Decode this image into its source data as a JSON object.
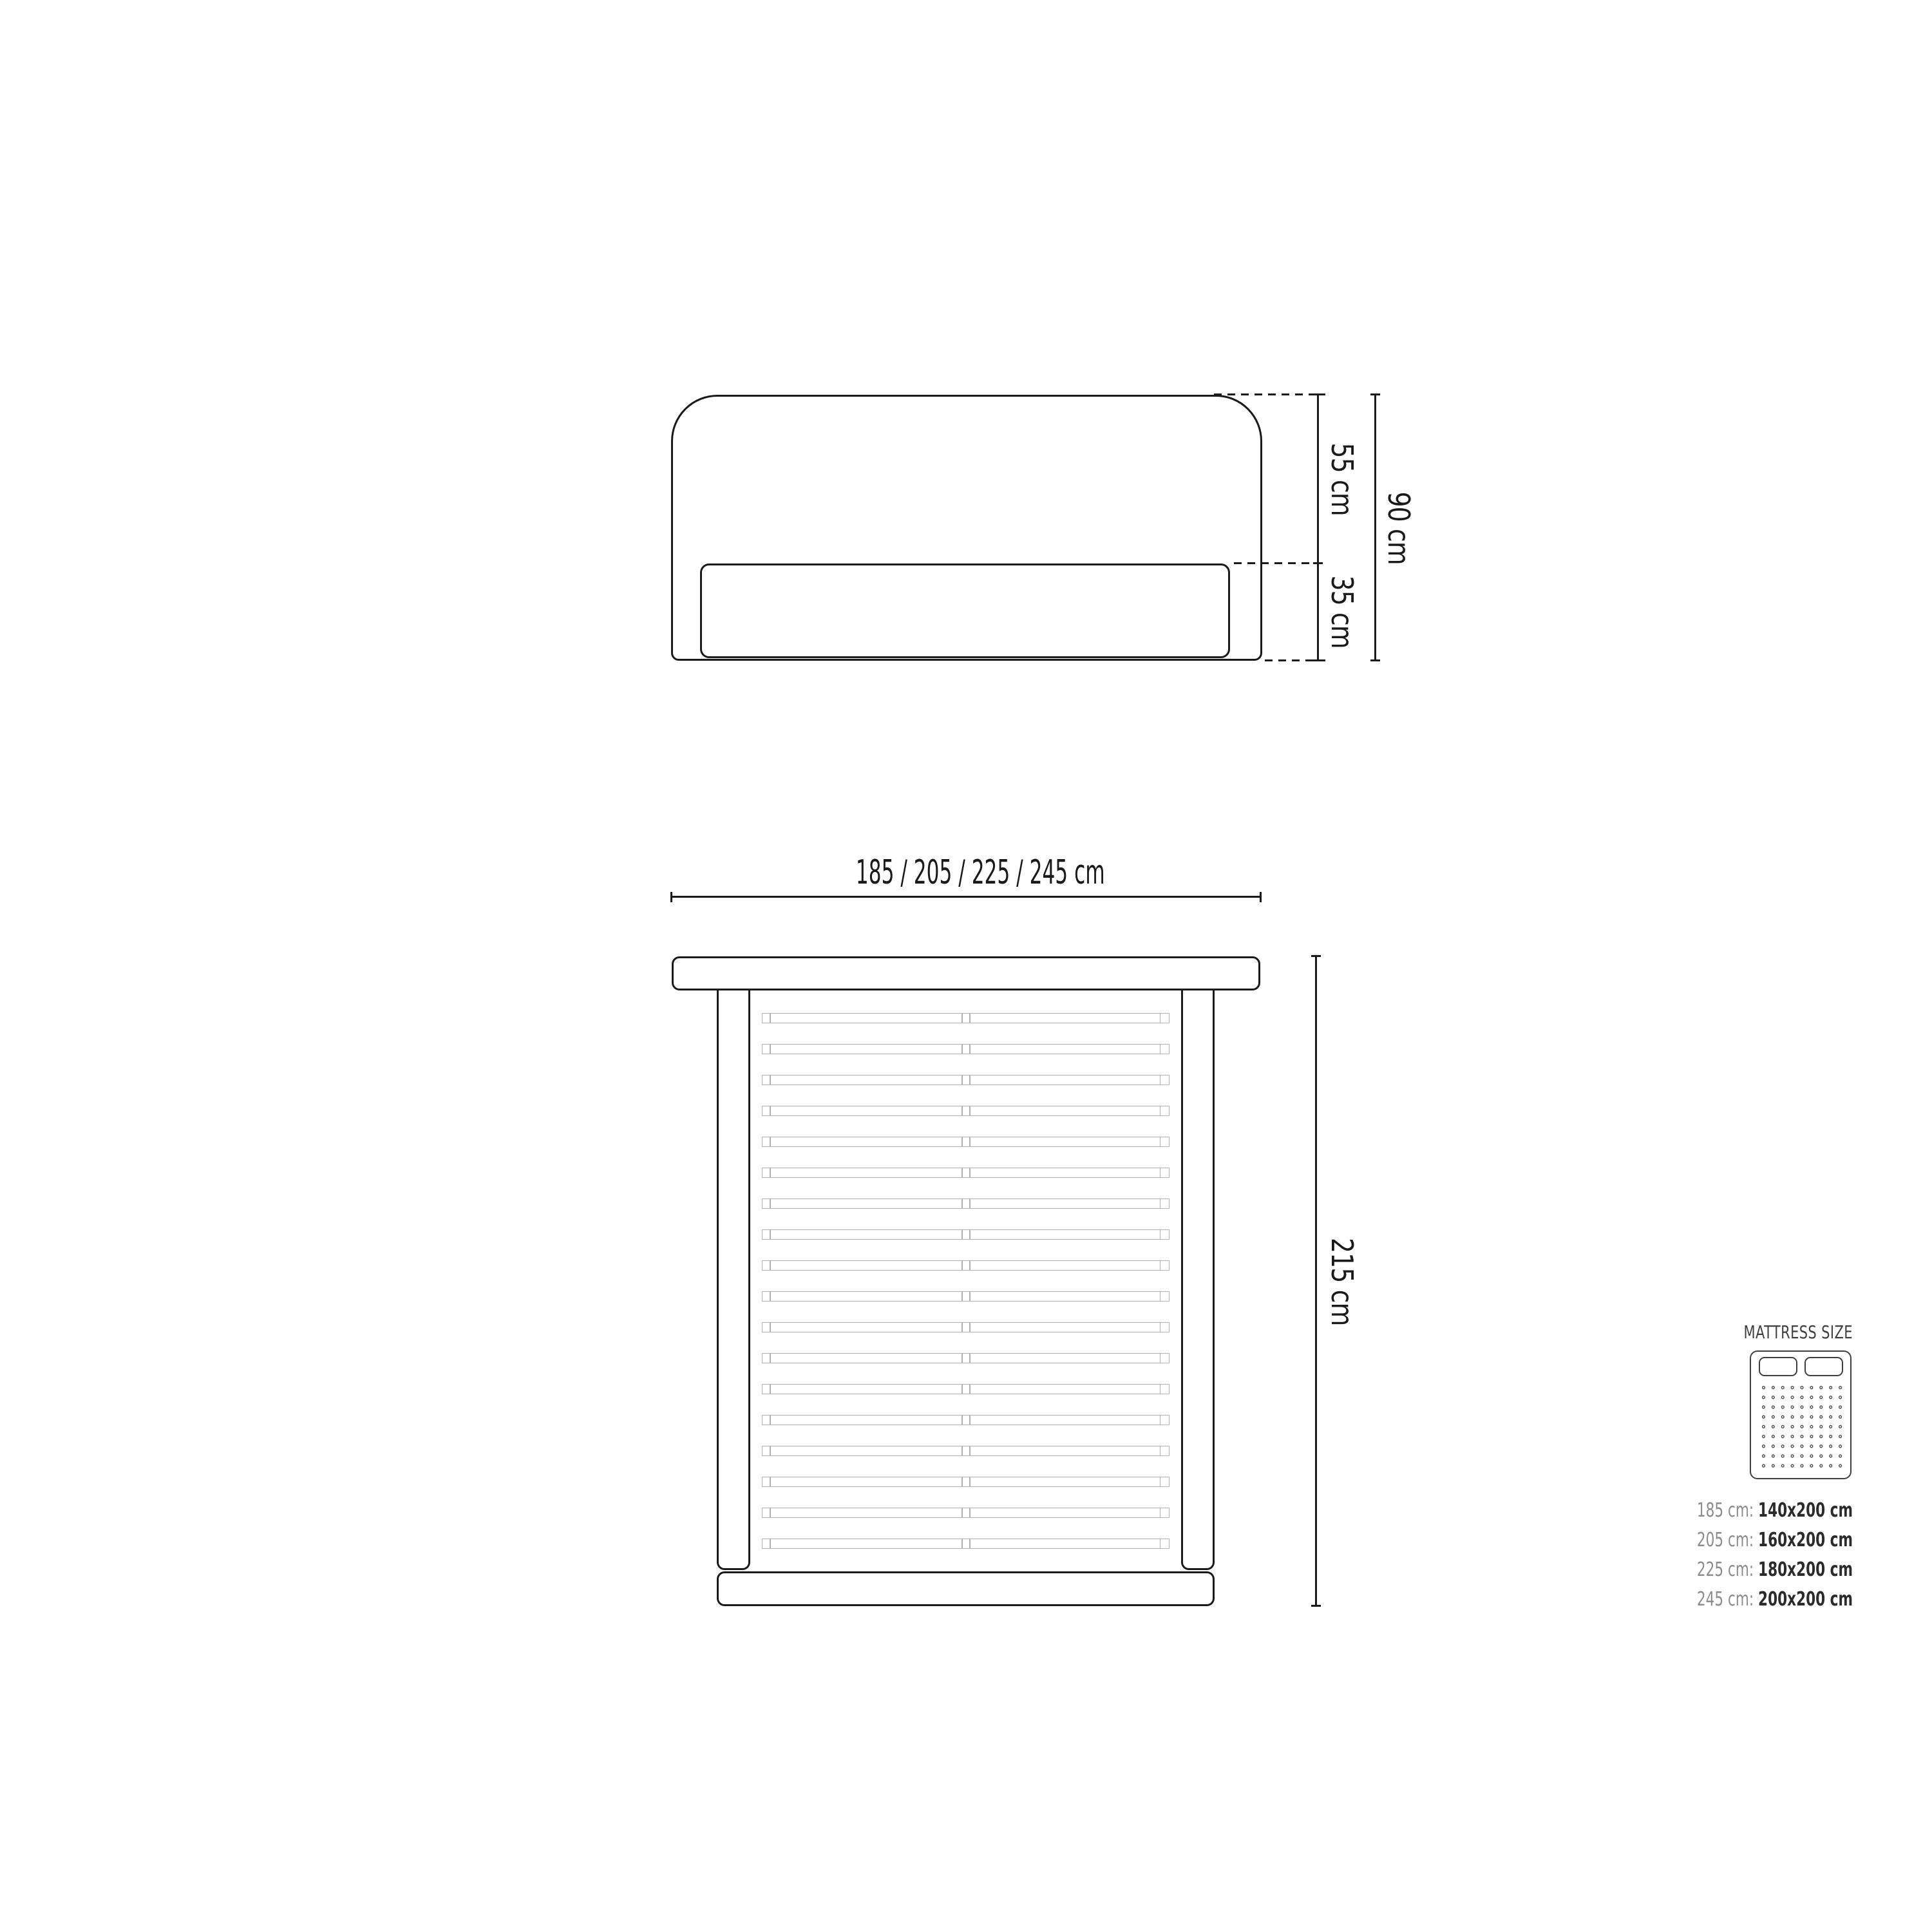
{
  "side_view": {
    "upper_height_label": "55 cm",
    "lower_height_label": "35 cm",
    "total_height_label": "90 cm"
  },
  "plan_view": {
    "width_label": "185 / 205 / 225 / 245 cm",
    "length_label": "215 cm",
    "slat_count": 18
  },
  "mattress_legend": {
    "title": "MATTRESS SIZE",
    "rows": [
      {
        "bed_width": "185 cm:",
        "mattress_size": "140x200 cm"
      },
      {
        "bed_width": "205 cm:",
        "mattress_size": "160x200 cm"
      },
      {
        "bed_width": "225 cm:",
        "mattress_size": "180x200 cm"
      },
      {
        "bed_width": "245 cm:",
        "mattress_size": "200x200 cm"
      }
    ]
  },
  "colors": {
    "line": "#1a1a1a",
    "slat_line": "#b0b0b0",
    "muted_text": "#8c8c8c",
    "strong_text": "#2b2b2b",
    "legend_line": "#3f3f3f"
  }
}
